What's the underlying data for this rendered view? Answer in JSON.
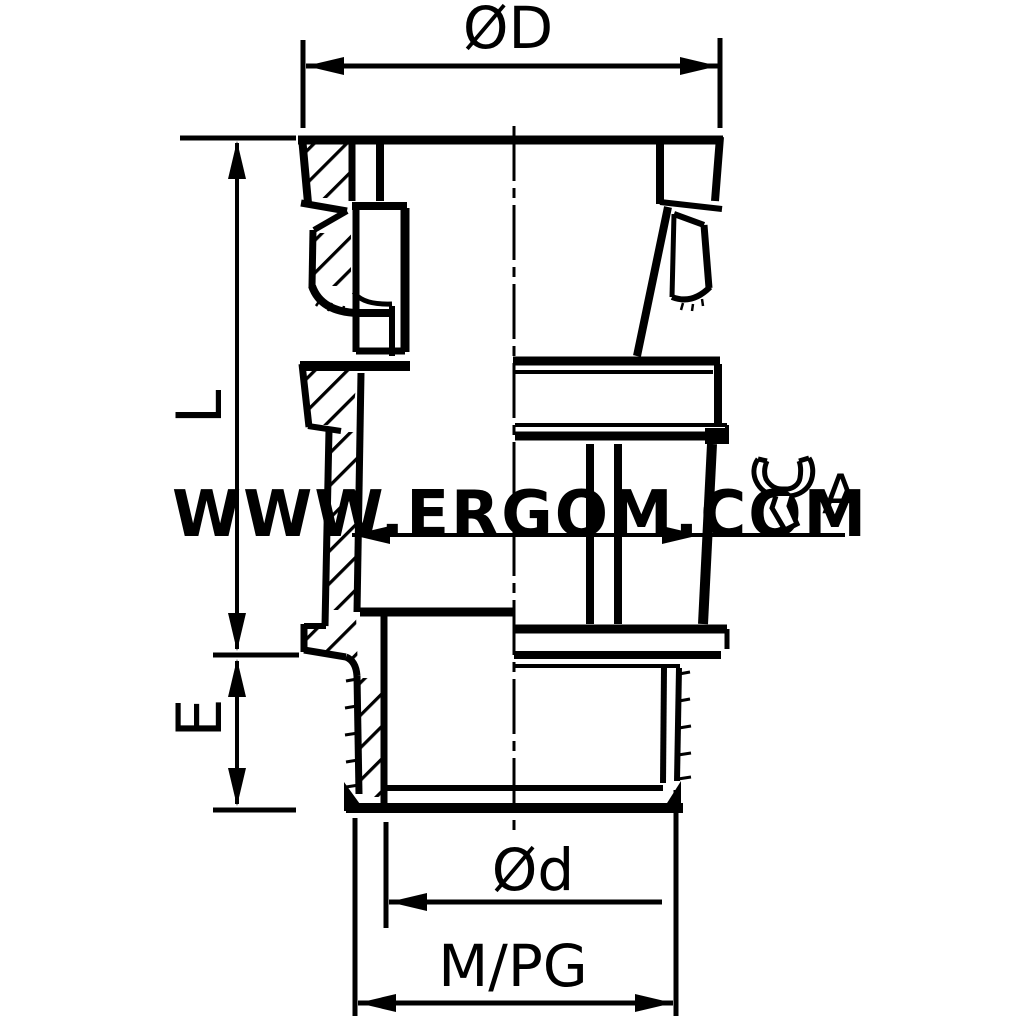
{
  "page": {
    "background_color": "#ffffff",
    "line_color": "#000000"
  },
  "watermark": {
    "text": "WWW.ERGOM.COM",
    "color": "#f3f3f3"
  },
  "drawing": {
    "type": "cable-gland-cross-section",
    "labels": {
      "diameter_top": "ØD",
      "length": "L",
      "thread_length": "E",
      "wrench_size": "A",
      "diameter_bottom": "Ød",
      "thread_designation": "M/PG"
    }
  }
}
